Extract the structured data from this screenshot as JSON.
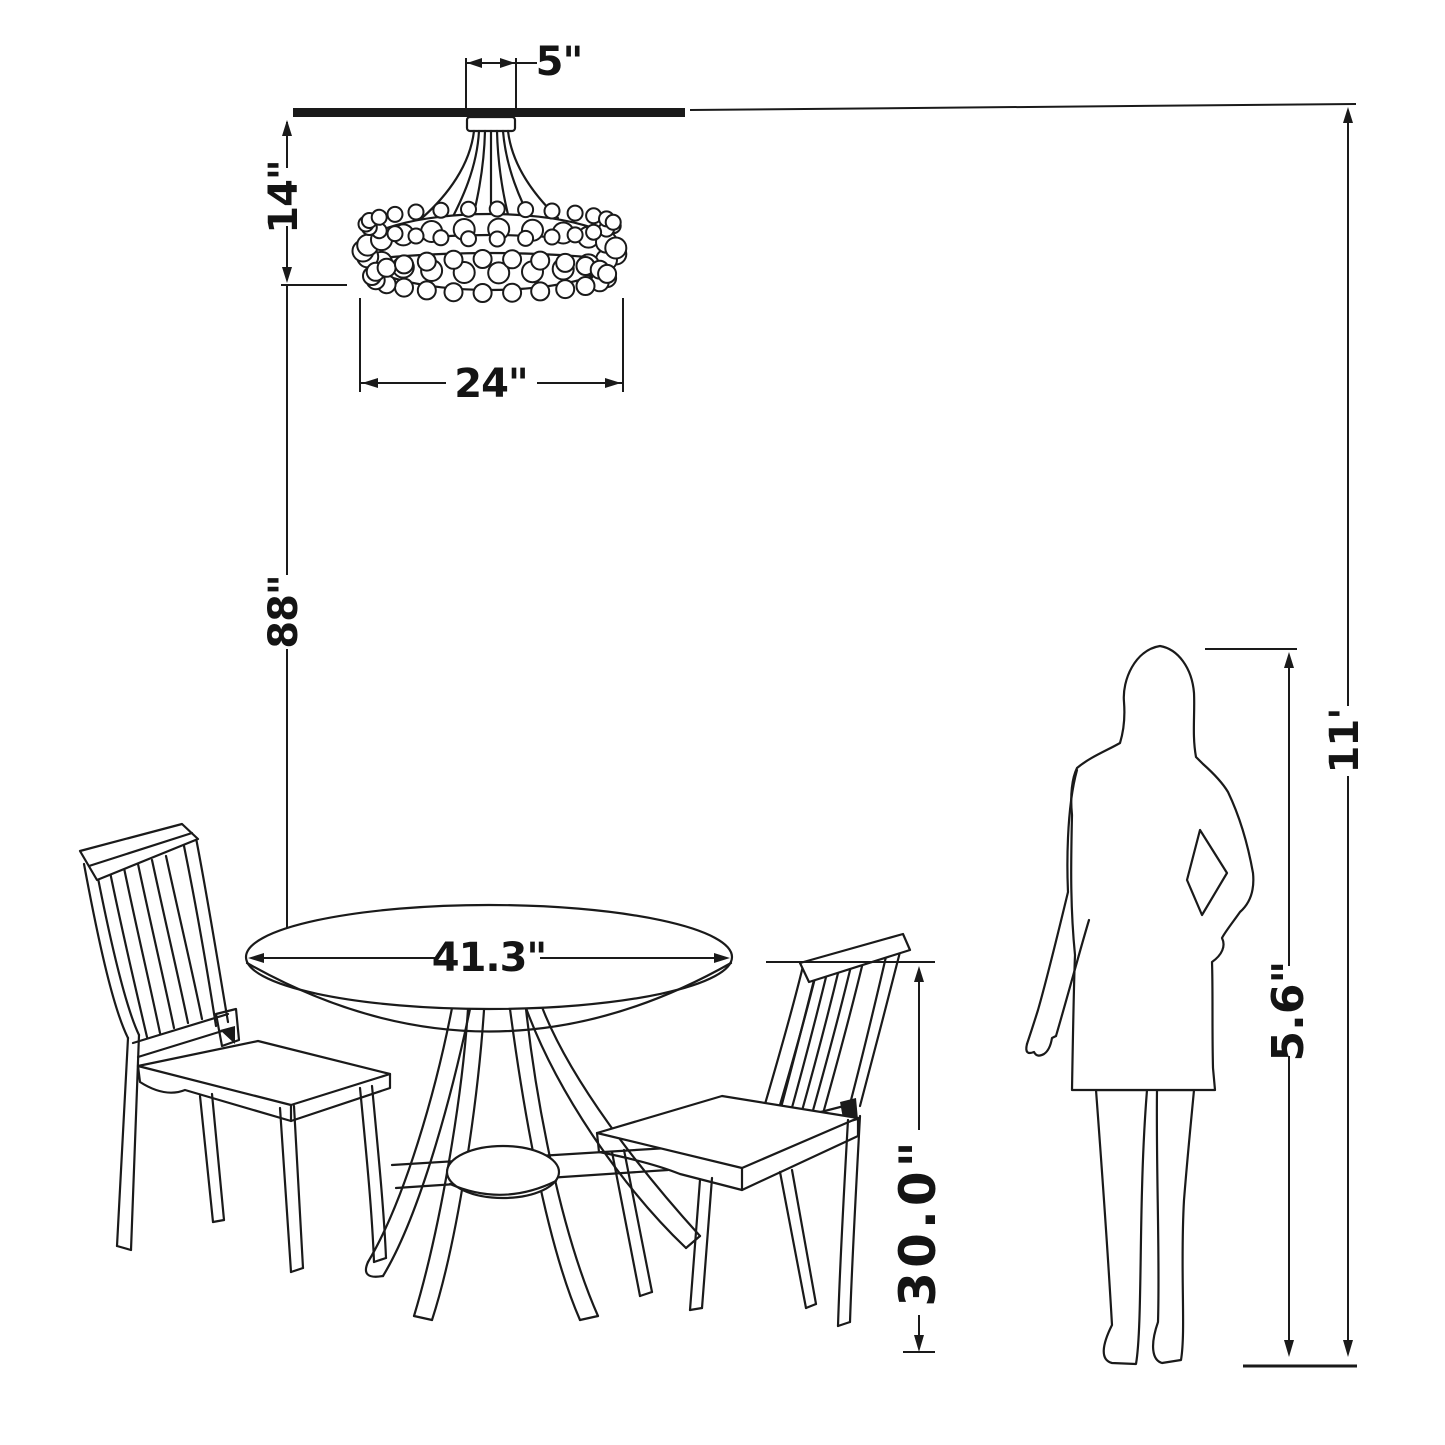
{
  "page": {
    "background": "#ffffff",
    "ink": "#1a1a1a"
  },
  "diagram": {
    "type": "furniture-dimension-diagram",
    "scene": "Dining set with flush-mount crystal chandelier, round pedestal table, two side chairs and a human silhouette shown for scale against ceiling height",
    "dimensions": {
      "canopy_width": "5\"",
      "chandelier_height": "14\"",
      "chandelier_diameter": "24\"",
      "chandelier_to_table": "88\"",
      "table_diameter": "41.3\"",
      "table_height": "30.0\"",
      "person_height": "5.6\"",
      "ceiling_height": "11'"
    }
  }
}
